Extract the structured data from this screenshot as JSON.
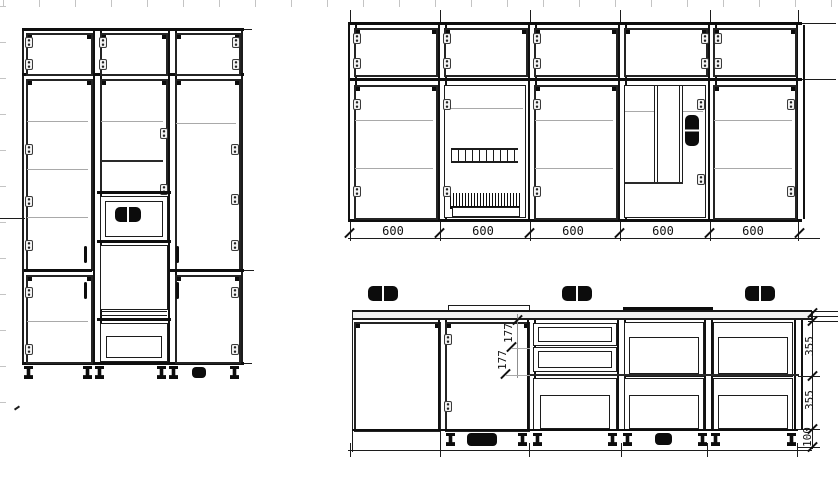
{
  "colors": {
    "line": "#1c1c1c",
    "heavy_line": "#0e0e0e",
    "shelf_line": "#a9a9a9",
    "ruler_tick": "#c4c4c4",
    "dim_text": "#111111",
    "background": "#ffffff"
  },
  "dims": {
    "wall_widths": [
      "600",
      "600",
      "600",
      "600",
      "600"
    ],
    "drawer_heights": [
      "177",
      "177"
    ],
    "right_chain": [
      "355",
      "355",
      "100"
    ]
  }
}
